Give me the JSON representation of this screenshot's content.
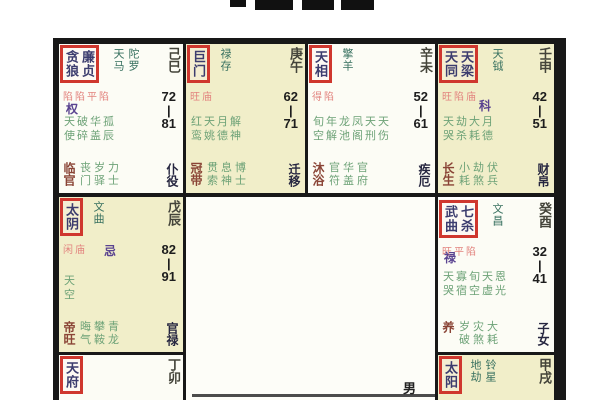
{
  "meta": {
    "description_label": "紫微斗数命盘",
    "gender_char": "男"
  },
  "chart": {
    "cells": {
      "si": {
        "branch": "己巳",
        "box_stars": [
          "贪狼",
          "廉贞"
        ],
        "side_stars": [
          "天马",
          "陀罗"
        ],
        "brightness": "陷陷平陷",
        "hua": "权",
        "age_top": "72",
        "age_sep": "|",
        "age_bottom": "81",
        "mid1": "天破华孤",
        "mid2": "使碎盖辰",
        "stage": "临官",
        "off1": "丧岁力",
        "off2": "门驿士",
        "palace": "仆役"
      },
      "wu": {
        "branch": "庚午",
        "box_stars": [
          "巨门"
        ],
        "side_stars": [
          "禄存"
        ],
        "brightness": "旺庙",
        "hua": "",
        "age_top": "62",
        "age_sep": "|",
        "age_bottom": "71",
        "mid1": "红天月解",
        "mid2": "鸾姚德神",
        "stage": "冠带",
        "off1": "贯息博",
        "off2": "索神士",
        "palace": "迁移"
      },
      "wei": {
        "branch": "辛未",
        "box_stars": [
          "天相"
        ],
        "side_stars": [
          "擎羊"
        ],
        "brightness": "得陷",
        "hua": "",
        "age_top": "52",
        "age_sep": "|",
        "age_bottom": "61",
        "mid1": "旬年龙凤天天",
        "mid2": "空解池阁刑伤",
        "stage": "沐浴",
        "off1": "官华官",
        "off2": "符盖府",
        "palace": "疾厄"
      },
      "shen": {
        "branch": "壬申",
        "box_stars": [
          "天同",
          "天梁"
        ],
        "side_stars": [
          "天钺"
        ],
        "brightness": "旺陷庙",
        "hua": "科",
        "age_top": "42",
        "age_sep": "|",
        "age_bottom": "51",
        "mid1": "天劫大月",
        "mid2": "哭杀耗德",
        "stage": "长生",
        "off1": "小劫伏",
        "off2": "耗煞兵",
        "palace": "财帛"
      },
      "chen": {
        "branch": "戊辰",
        "box_stars": [
          "太阴"
        ],
        "side_stars": [
          "文曲"
        ],
        "brightness": "闲庙",
        "hua": "忌",
        "age_top": "82",
        "age_sep": "|",
        "age_bottom": "91",
        "mid1": "天",
        "mid2": "空",
        "stage": "帝旺",
        "off1": "晦攀青",
        "off2": "气鞍龙",
        "palace": "官禄"
      },
      "you": {
        "branch": "癸酉",
        "box_stars": [
          "武曲",
          "七杀"
        ],
        "side_stars": [
          "文昌"
        ],
        "brightness": "旺平陷",
        "hua": "禄",
        "age_top": "32",
        "age_sep": "|",
        "age_bottom": "41",
        "mid1": "天寡旬天恩",
        "mid2": "哭宿空虚光",
        "stage": "养",
        "off1": "岁灾大",
        "off2": "破煞耗",
        "palace": "子女"
      },
      "mao": {
        "branch": "丁卯",
        "box_stars": [
          "天府"
        ],
        "side_stars": [],
        "brightness": "庙",
        "hua": "",
        "age_top": "",
        "age_sep": "",
        "age_bottom": "",
        "mid1": "",
        "mid2": "",
        "stage": "",
        "off1": "",
        "off2": "",
        "palace": ""
      },
      "xu": {
        "branch": "甲戌",
        "box_stars": [
          "太阳"
        ],
        "side_stars": [
          "地劫",
          "铃星"
        ],
        "brightness": "陷庙",
        "hua": "",
        "age_top": "",
        "age_sep": "",
        "age_bottom": "",
        "mid1": "",
        "mid2": "",
        "stage": "",
        "off1": "",
        "off2": "",
        "palace": ""
      }
    }
  },
  "colors": {
    "red_box_border": "#cf372e",
    "yellow_cell": "#f1eec9",
    "white_cell": "#fcfcf5",
    "minor_star_green": "#6da277",
    "side_star_teal": "#37705f",
    "brightness_pink": "#e2837e",
    "hua_purple": "#5a4390",
    "stage_maroon": "#8a4436",
    "palace_navy": "#262640"
  }
}
